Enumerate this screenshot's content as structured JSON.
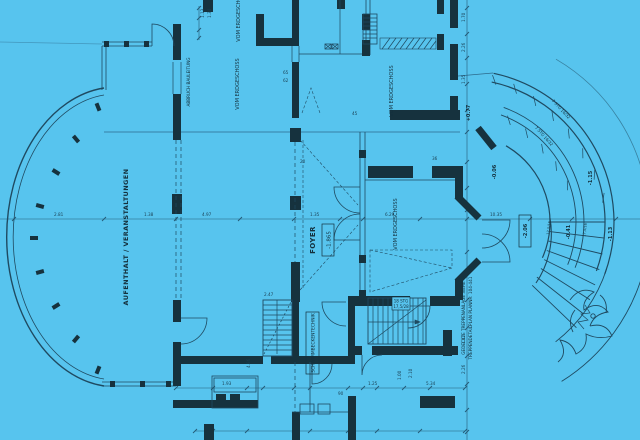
{
  "meta": {
    "background_color": "#57c4ee",
    "wall_color": "#16323e",
    "line_color": "#1f4a61",
    "dim_color": "#245a76",
    "drawing_type": "architectural floor plan blueprint"
  },
  "labels": {
    "hall": "AUFENTHALT / VERANSTALTUNGEN",
    "foyer": "FOYER",
    "foyer_level": "-1.865",
    "from_ground_1": "VOM ERDGESCHOSS",
    "from_ground_2": "VOM ERDGESCHOSS",
    "from_ground_3": "VOM ERDGESCHOSS",
    "from_ground_4": "VOM ERDGESCHOSS",
    "abbruch": "ABBRUCH BAULEITUNG",
    "pool_tech": "SCHWIMMBECKENTECHNIK",
    "stair_note_1": "GEDECKTE TREPPENANLAGE SIEHE",
    "stair_note_2": "TREPPENDETAILPLAN PLANNR: 104-441",
    "stair2_line1": "18 STG",
    "stair2_line2": "17,5/28",
    "arc_stair_1": "7 STG 16/32",
    "arc_stair_2": "7 STG 16/32",
    "fan_step_1": "17,5/16",
    "fan_step_2": "17,5/16"
  },
  "levels": {
    "terrace_boxed": "-2.06",
    "fan_mid": "-0.41",
    "fan_out": "-1.13",
    "walk_top": "-1.15",
    "upper": "-0.06",
    "entry": "+0.77"
  },
  "dims": [
    "2.81",
    "4.97",
    "1.35",
    "6.29",
    "10.35",
    "1.70",
    "2.26",
    "1.35",
    "1.13",
    "1.34",
    "1.93",
    "90",
    "1.25",
    "2.10",
    "1.00",
    "4.86",
    "1.38",
    "2.47",
    "1.12",
    "2.26",
    "65",
    "62",
    "5.34",
    "45",
    "20",
    "36"
  ]
}
